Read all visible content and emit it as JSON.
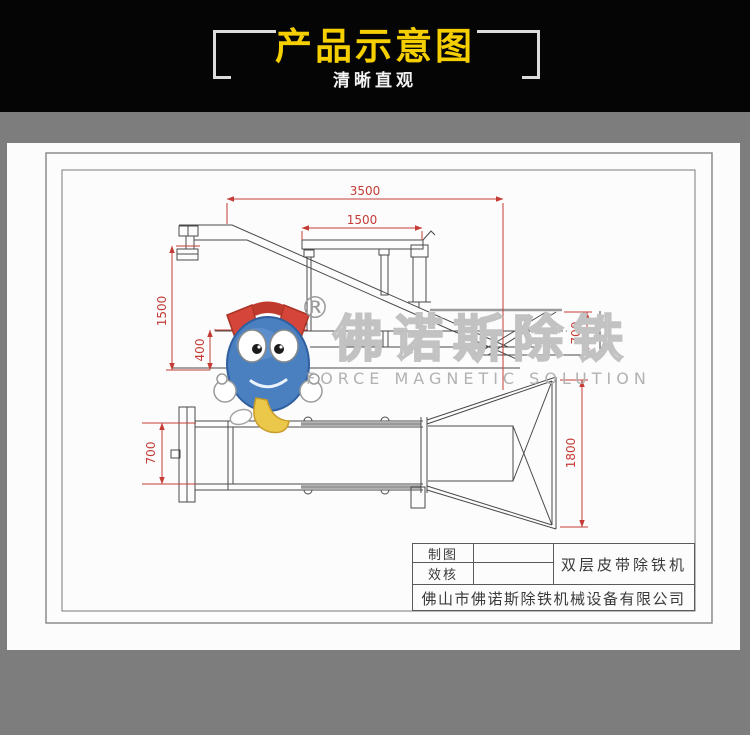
{
  "header": {
    "title": "产品示意图",
    "subtitle": "清晰直观",
    "title_color": "#f6cf00",
    "background_color": "#050505"
  },
  "drawing": {
    "dimensions": {
      "total_length": "3500",
      "magnet_length": "1500",
      "left_height": "1500",
      "layer_gap": "400",
      "hopper_depth": "700",
      "conveyor_width": "700",
      "hopper_width": "1800"
    },
    "colors": {
      "dimension_red": "#c43c35",
      "line_gray": "#4a4a4a",
      "paper_white": "#fcfcfc",
      "background_gray": "#7d7d7d"
    }
  },
  "watermark": {
    "registered_symbol": "®",
    "brand_cn": "佛诺斯除铁",
    "brand_en": "FORCE MAGNETIC SOLUTION"
  },
  "title_block": {
    "drafter_label": "制图",
    "drafter_value": "",
    "checker_label": "效核",
    "checker_value": "",
    "product_name": "双层皮带除铁机",
    "company": "佛山市佛诺斯除铁机械设备有限公司"
  }
}
